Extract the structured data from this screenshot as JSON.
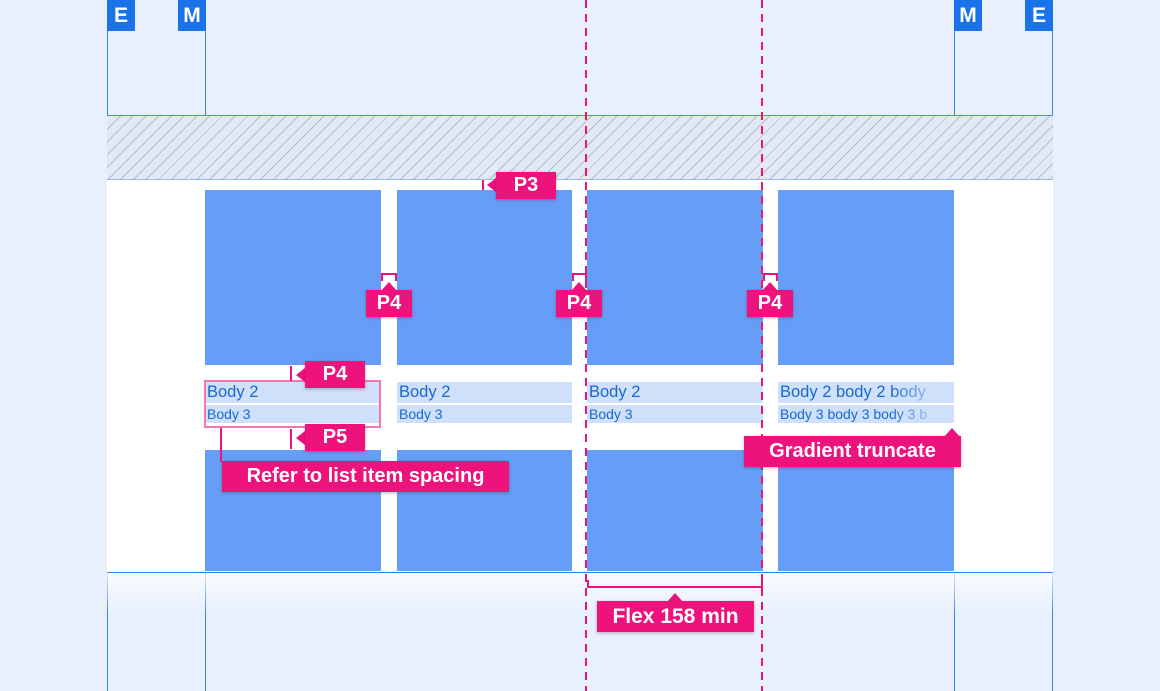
{
  "colors": {
    "background": "#E8F0FE",
    "guide-blue": "#1A73E8",
    "card-blue": "#669DF6",
    "highlight-blue": "#CFE0FB",
    "text-blue": "#1967D2",
    "accent-pink": "#ED127C",
    "redline-pink": "#F277AD",
    "hatch-line": "#B3BBCD"
  },
  "markers": {
    "outer_left": "E",
    "inner_left": "M",
    "inner_right": "M",
    "outer_right": "E"
  },
  "annotations": {
    "p3_label": "P3",
    "p4_label": "P4",
    "p5_label": "P5",
    "refer_label": "Refer to list item spacing",
    "gradient_label": "Gradient truncate",
    "flex_label": "Flex 158 min"
  },
  "cards": [
    {
      "body2": "Body 2",
      "body3": "Body 3"
    },
    {
      "body2": "Body 2",
      "body3": "Body 3"
    },
    {
      "body2": "Body 2",
      "body3": "Body 3"
    },
    {
      "body2": "Body 2 body 2 body",
      "body3": "Body 3 body 3 body 3 b"
    }
  ]
}
